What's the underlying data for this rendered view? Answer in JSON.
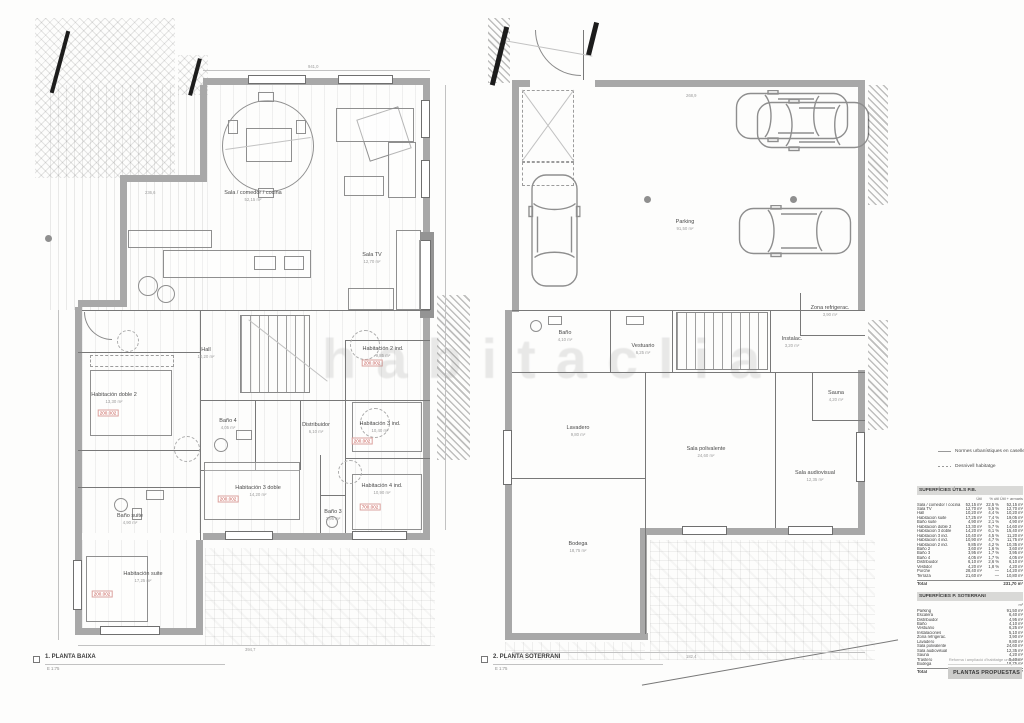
{
  "watermark": "habitaclia",
  "plans": {
    "left": {
      "title": "1. PLANTA BAIXA",
      "scale": "E 1:75",
      "rooms": [
        {
          "name": "Sala / comedor / cocina",
          "area": "52,15 m²"
        },
        {
          "name": "Sala TV",
          "area": "12,70 m²"
        },
        {
          "name": "Hall",
          "area": "10,20 m²"
        },
        {
          "name": "Habitación doble 2",
          "area": "13,30 m²"
        },
        {
          "name": "Baño 4",
          "area": "4,05 m²"
        },
        {
          "name": "Distribuidor",
          "area": "6,10 m²"
        },
        {
          "name": "Habitación 3 ind.",
          "area": "10,40 m²"
        },
        {
          "name": "Habitación 3 doble",
          "area": "14,20 m²"
        },
        {
          "name": "Habitación 4 ind.",
          "area": "10,90 m²"
        },
        {
          "name": "Baño 3",
          "area": "3,95 m²"
        },
        {
          "name": "Baño suite",
          "area": "4,90 m²"
        },
        {
          "name": "Habitación suite",
          "area": "17,25 m²"
        },
        {
          "name": "Habitación 2 ind.",
          "area": "9,85 m²"
        }
      ],
      "codes": [
        "200.002",
        "200.002",
        "200.002",
        "200.002",
        "700.002",
        "200.002"
      ]
    },
    "right": {
      "title": "2. PLANTA SOTERRANI",
      "scale": "E 1:75",
      "rooms": [
        {
          "name": "Parking",
          "area": "91,50 m²"
        },
        {
          "name": "Baño",
          "area": "4,10 m²"
        },
        {
          "name": "Vestuario",
          "area": "6,25 m²"
        },
        {
          "name": "Instalac.",
          "area": "3,20 m²"
        },
        {
          "name": "Zona refrigerac.",
          "area": "3,90 m²"
        },
        {
          "name": "Lavadero",
          "area": "9,80 m²"
        },
        {
          "name": "Sala polivalente",
          "area": "24,60 m²"
        },
        {
          "name": "Sala audiovisual",
          "area": "12,35 m²"
        },
        {
          "name": "Sauna",
          "area": "4,20 m²"
        },
        {
          "name": "Bodega",
          "area": "18,75 m²"
        }
      ]
    }
  },
  "legend": {
    "items": [
      {
        "label": "Normes urbanístiques en caselles"
      },
      {
        "label": "Desnivell habitatge"
      }
    ]
  },
  "tables": [
    {
      "title": "SUPERFÍCIES ÚTILS P.B.",
      "headers": [
        "Útil",
        "% útil",
        "Útil + armaris"
      ],
      "rows": [
        {
          "n": "Sala / comedor / cocina",
          "a": "52,15 m²",
          "b": "22,5 %",
          "c": "52,15 m²"
        },
        {
          "n": "Sala TV",
          "a": "12,70 m²",
          "b": "5,5 %",
          "c": "12,70 m²"
        },
        {
          "n": "Hall",
          "a": "10,20 m²",
          "b": "4,4 %",
          "c": "10,20 m²"
        },
        {
          "n": "Habitación suite",
          "a": "17,25 m²",
          "b": "7,4 %",
          "c": "19,05 m²"
        },
        {
          "n": "Baño suite",
          "a": "4,90 m²",
          "b": "2,1 %",
          "c": "4,90 m²"
        },
        {
          "n": "Habitación doble 2",
          "a": "13,30 m²",
          "b": "5,7 %",
          "c": "14,60 m²"
        },
        {
          "n": "Habitación 3 doble",
          "a": "14,20 m²",
          "b": "6,1 %",
          "c": "15,40 m²"
        },
        {
          "n": "Habitación 3 ind.",
          "a": "10,40 m²",
          "b": "4,5 %",
          "c": "11,20 m²"
        },
        {
          "n": "Habitación 4 ind.",
          "a": "10,90 m²",
          "b": "4,7 %",
          "c": "11,75 m²"
        },
        {
          "n": "Habitación 2 ind.",
          "a": "9,85 m²",
          "b": "4,2 %",
          "c": "10,35 m²"
        },
        {
          "n": "Baño 2",
          "a": "3,60 m²",
          "b": "1,6 %",
          "c": "3,60 m²"
        },
        {
          "n": "Baño 3",
          "a": "3,95 m²",
          "b": "1,7 %",
          "c": "3,95 m²"
        },
        {
          "n": "Baño 4",
          "a": "4,05 m²",
          "b": "1,7 %",
          "c": "4,05 m²"
        },
        {
          "n": "Distribuidor",
          "a": "6,10 m²",
          "b": "2,6 %",
          "c": "6,10 m²"
        },
        {
          "n": "Vestidor",
          "a": "4,20 m²",
          "b": "1,8 %",
          "c": "4,20 m²"
        },
        {
          "n": "Porche",
          "a": "28,40 m²",
          "b": "—",
          "c": "14,20 m²"
        },
        {
          "n": "Terraza",
          "a": "21,60 m²",
          "b": "—",
          "c": "10,80 m²"
        }
      ],
      "total_label": "Total",
      "total_value": "231,70 m²"
    },
    {
      "title": "SUPERFÍCIES P. SOTERRANI",
      "unit": "m²",
      "rows": [
        {
          "n": "Parking",
          "v": "91,50 m²"
        },
        {
          "n": "Escalera",
          "v": "6,40 m²"
        },
        {
          "n": "Distribuidor",
          "v": "4,95 m²"
        },
        {
          "n": "Baño",
          "v": "4,10 m²"
        },
        {
          "n": "Vestuario",
          "v": "6,25 m²"
        },
        {
          "n": "Instalaciones",
          "v": "5,10 m²"
        },
        {
          "n": "Zona refrigerac.",
          "v": "3,90 m²"
        },
        {
          "n": "Lavadero",
          "v": "9,80 m²"
        },
        {
          "n": "Sala polivalente",
          "v": "24,60 m²"
        },
        {
          "n": "Sala audiovisual",
          "v": "12,35 m²"
        },
        {
          "n": "Sauna",
          "v": "4,20 m²"
        },
        {
          "n": "Trastero",
          "v": "5,40 m²"
        },
        {
          "n": "Bodega",
          "v": "18,75 m²"
        }
      ],
      "total_label": "Total",
      "total_value": "197,30 m²"
    }
  ],
  "titleblock": {
    "project": "Reforma i ampliació d'habitatge unifamiliar",
    "sheet": "PLANTAS PROPUESTAS"
  },
  "dims": [
    "941,0",
    "394,7",
    "268,9",
    "182,4",
    "236,6"
  ]
}
